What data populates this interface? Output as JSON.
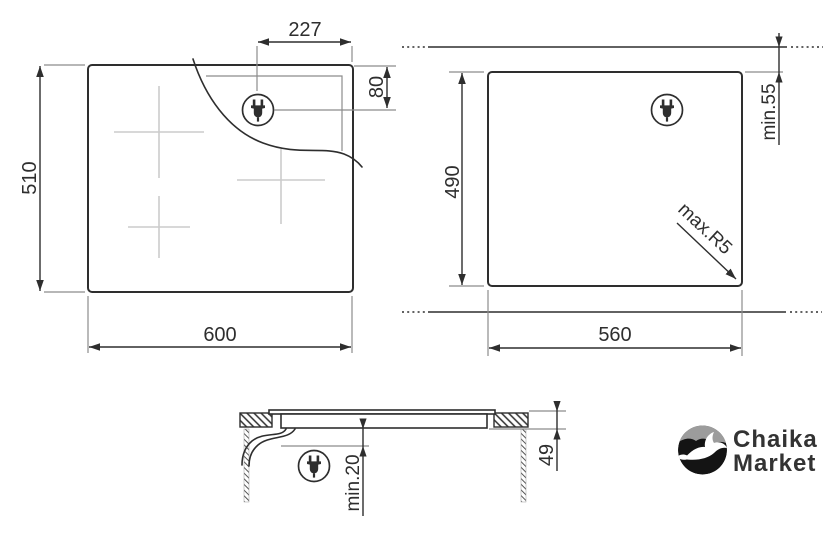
{
  "colors": {
    "background": "#ffffff",
    "line": "#2e2e2e",
    "extension": "#8c8c8c",
    "burner_cross": "#cccccc",
    "logo_sky": "#9c9c9c",
    "logo_ground": "#141414",
    "logo_text": "#333333"
  },
  "diagram": {
    "top_view": {
      "width": "600",
      "depth": "510",
      "plug_offset_x": "227",
      "plug_offset_y": "80"
    },
    "cutout_view": {
      "width": "560",
      "depth": "490",
      "rear_clearance": "min.55",
      "corner_radius": "max.R5"
    },
    "section_view": {
      "installed_height": "49",
      "bottom_clearance": "min.20"
    }
  },
  "logo": {
    "name": "Chaika Market",
    "line1": "Chaika",
    "line2": "Market"
  }
}
